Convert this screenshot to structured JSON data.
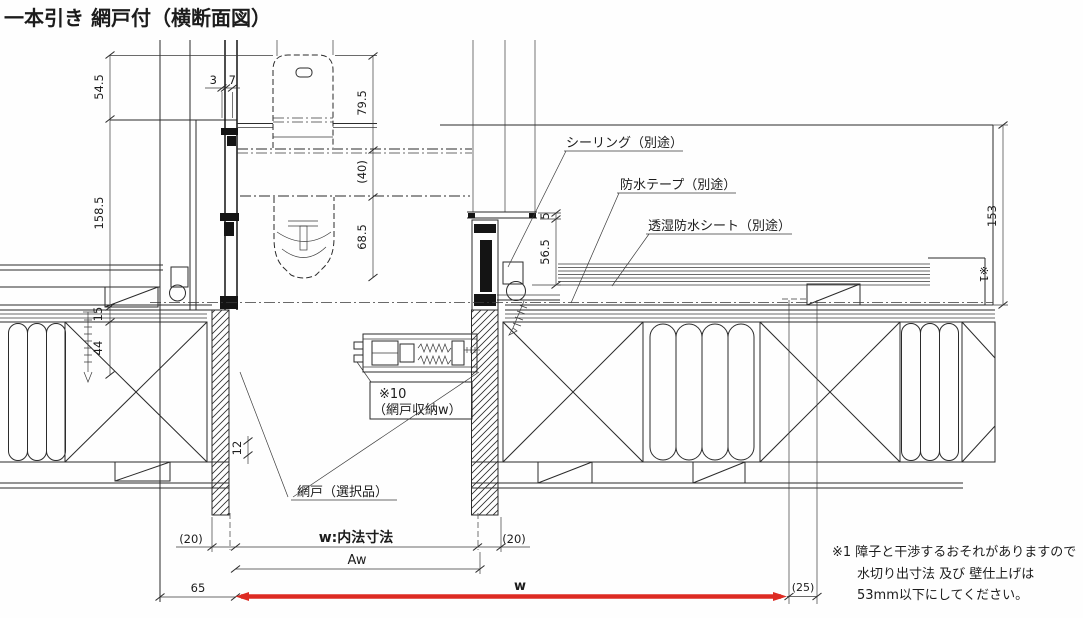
{
  "title": "一本引き 網戸付（横断面図）",
  "colors": {
    "line": "#2b2b2b",
    "accent_red": "#dd2b23",
    "background": "#ffffff"
  },
  "drawing_type": "横断面図（プラン断面・CAD図）",
  "callouts": {
    "sealing": "シーリング（別途）",
    "waterproof_tape": "防水テープ（別途）",
    "waterproof_sheet": "透湿防水シート（別途）",
    "screen_ref_no": "※10",
    "screen_storage": "（網戸収納w）",
    "screen_door": "網戸（選択品）",
    "wall_ref": "※1"
  },
  "dimensions": {
    "top_offset": "54.5",
    "frame_depth": "158.5",
    "d3": "3",
    "d7": "7",
    "d79_5": "79.5",
    "d40": "(40)",
    "d68_5": "68.5",
    "d5": "5",
    "d56_5": "56.5",
    "d153": "153",
    "d15": "15",
    "d44": "44",
    "d12": "12",
    "d20_left": "(20)",
    "inner_width": "w:内法寸法",
    "d20_right": "(20)",
    "aw": "Aw",
    "d65": "65",
    "w": "w",
    "d25": "(25)"
  },
  "note": {
    "line1": "※1 障子と干渉するおそれがありますので",
    "line2": "水切り出寸法 及び 壁仕上げは",
    "line3": "53mm以下にしてください。"
  }
}
